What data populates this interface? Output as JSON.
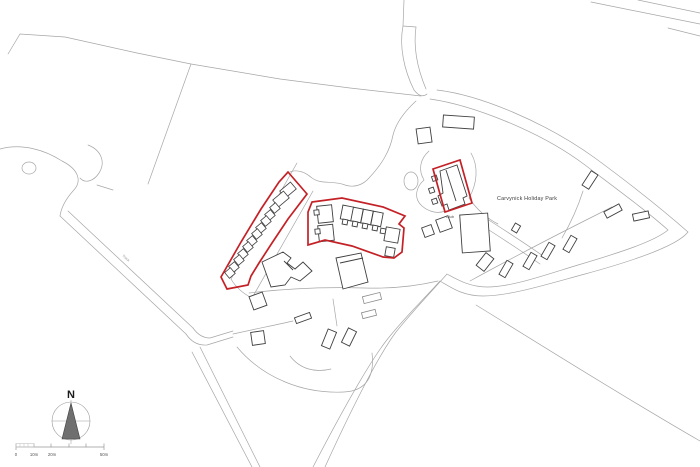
{
  "map": {
    "park_label": "Carvynick Holiday Park",
    "club_label": "Club",
    "track_label": "Track",
    "compass_label": "N",
    "scale": {
      "zero": "0",
      "ten": "10m",
      "twenty": "20m",
      "fifty": "50m"
    },
    "colors": {
      "boundary_red": "#c42127",
      "building_stroke": "#3f3f3f",
      "parcel_stroke": "#a6a6a6",
      "light_building_stroke": "#8a8a8a",
      "background": "#ffffff",
      "compass_fill": "#6f6f6f",
      "label_color": "#3c3c3c"
    }
  }
}
